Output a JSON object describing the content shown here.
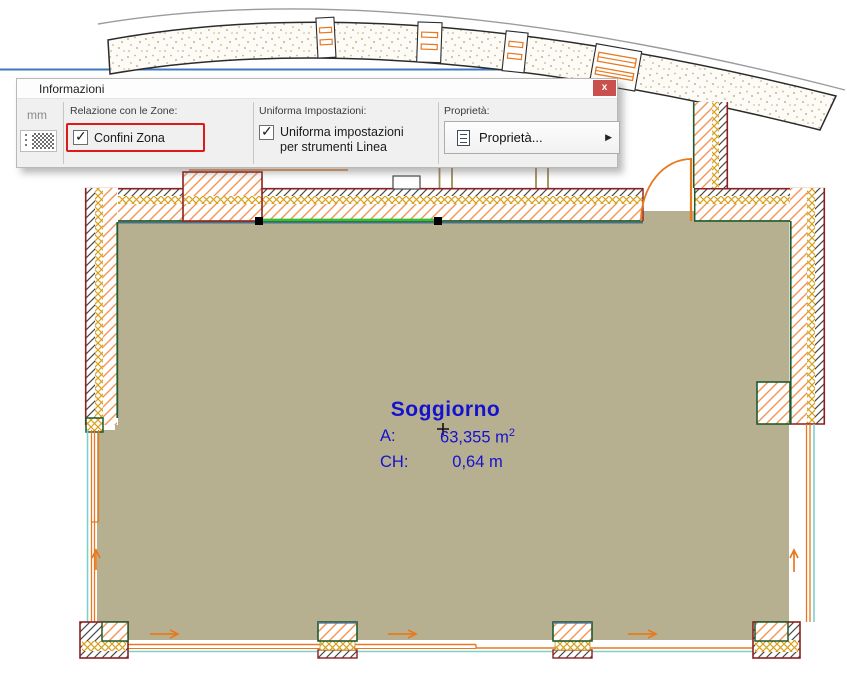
{
  "palette": {
    "title": "Informazioni",
    "unit_label": "mm",
    "sections": {
      "zone": {
        "header": "Relazione con le Zone:",
        "checkbox_label": "Confini Zona",
        "checked": true
      },
      "uniform": {
        "header": "Uniforma Impostazioni:",
        "checkbox_label": "Uniforma impostazioni per strumenti Linea",
        "checked": true
      },
      "properties": {
        "header": "Proprietà:",
        "button_label": "Proprietà..."
      }
    }
  },
  "zone_stamp": {
    "name": "Soggiorno",
    "area_label": "A:",
    "area_value": "63,355",
    "area_unit": "m",
    "area_exponent": "2",
    "height_label": "CH:",
    "height_value": "0,64",
    "height_unit": "m"
  },
  "icons": {
    "close": "x",
    "checkmark": "✓",
    "submenu_arrow": "▶"
  },
  "colors": {
    "zone_fill": "#b6b091",
    "zone_text_blue": "#1512cf",
    "selection_green": "#2ec42e",
    "wall_outer_red": "#8e1f1f",
    "wall_inner_green": "#1f5b2d",
    "hatch_orange": "#f29455",
    "insulation_gold": "#d8a01c",
    "boundary_cyan": "#7ed0cc",
    "guide_blue": "#3c78bc",
    "highlight_red": "#e01818",
    "close_button_red": "#c9504c",
    "flow_arrow_orange": "#e8791e"
  }
}
